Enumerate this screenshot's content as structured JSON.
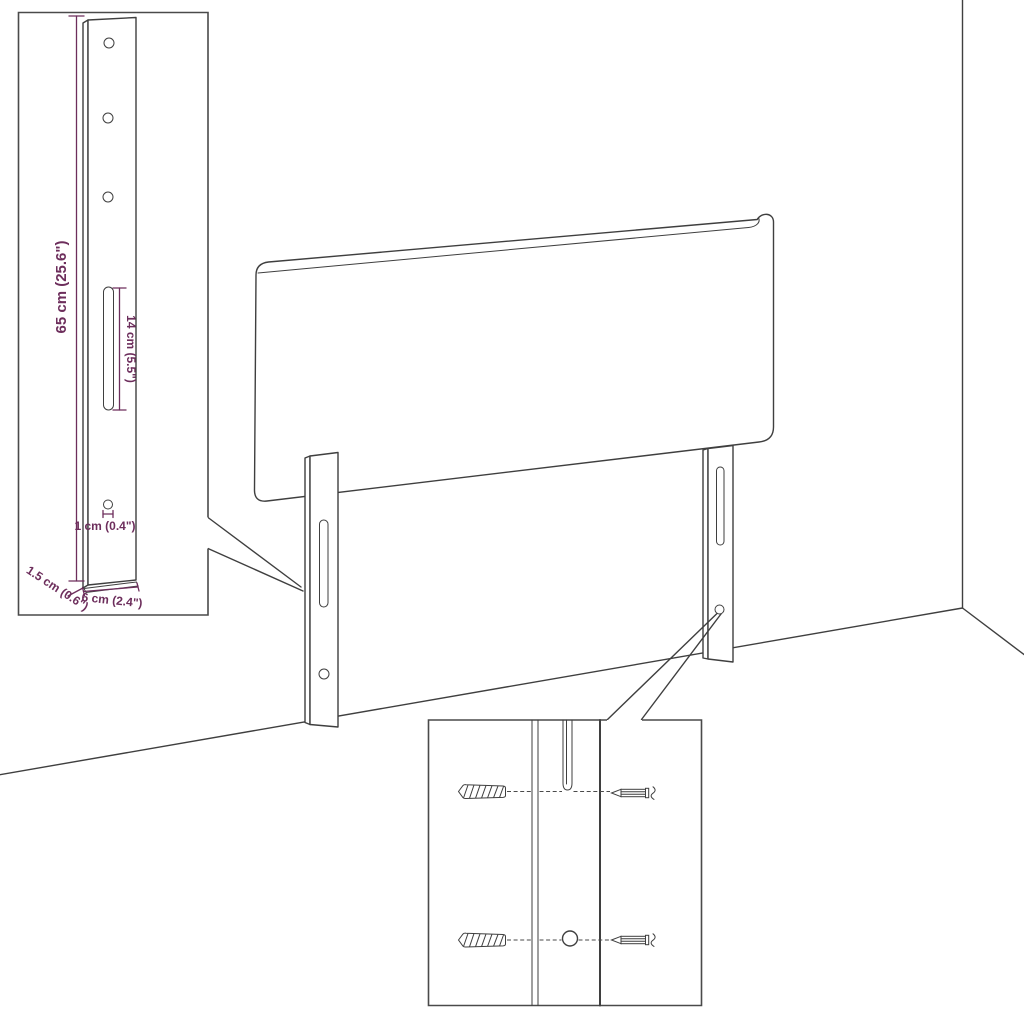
{
  "page": {
    "title": "Headboard assembly dimension diagram",
    "background": "#ffffff"
  },
  "colors": {
    "outline": "#3f3f3f",
    "inset_border": "#4a4a4a",
    "dimension": "#6d2e5c"
  },
  "labels": {
    "leg_height": "65 cm (25.6\")",
    "slot_length": "14 cm (5.5\")",
    "hole_diameter": "1 cm (0.4\")",
    "leg_thickness": "1.5 cm (0.6\")",
    "leg_width": "6 cm (2.4\")"
  },
  "icons": {
    "wall_plug": "wall-plug-icon",
    "screw": "screw-icon"
  }
}
